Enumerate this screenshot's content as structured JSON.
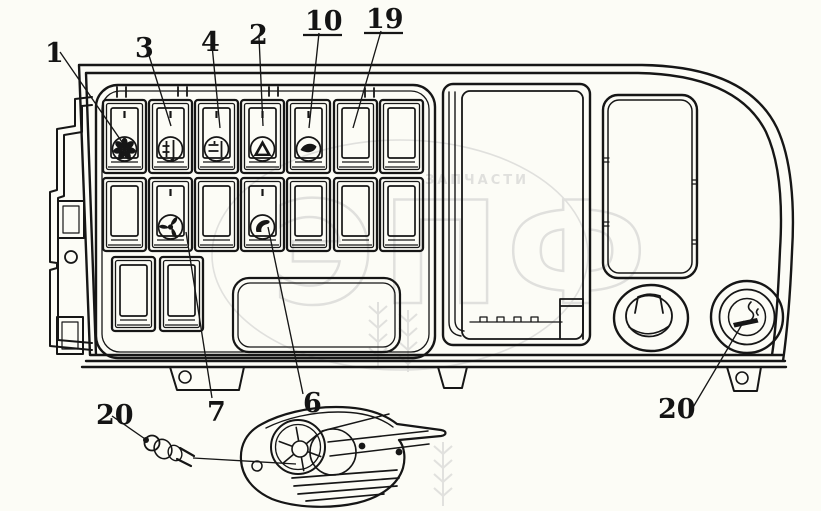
{
  "page": {
    "background": "#fcfcf6"
  },
  "artwork": {
    "line_color": "#161616",
    "watermark": {
      "color": "#c5c5c5",
      "small_text": "ЗАПЧАСТИ",
      "big_text": "ЭПФ"
    }
  },
  "callouts": [
    {
      "label": "1",
      "underlined": false
    },
    {
      "label": "3",
      "underlined": false
    },
    {
      "label": "4",
      "underlined": false
    },
    {
      "label": "2",
      "underlined": false
    },
    {
      "label": "10",
      "underlined": true
    },
    {
      "label": "19",
      "underlined": true
    },
    {
      "label": "7",
      "underlined": false
    },
    {
      "label": "6",
      "underlined": false
    },
    {
      "label": "20",
      "underlined": false
    },
    {
      "label": "20",
      "underlined": false
    }
  ],
  "switch_icons": {
    "row1": [
      "blower-fan",
      "heater-fan",
      "defroster",
      "hazard-warning",
      "washer",
      "blank",
      "blank"
    ],
    "row2": [
      "blank",
      "ventilation-fan",
      "blank",
      "horn",
      "blank",
      "blank",
      "blank"
    ],
    "row3": [
      "blank",
      "blank"
    ]
  },
  "right_controls": {
    "knob": "control-knob",
    "lighter": "cigarette-lighter"
  }
}
